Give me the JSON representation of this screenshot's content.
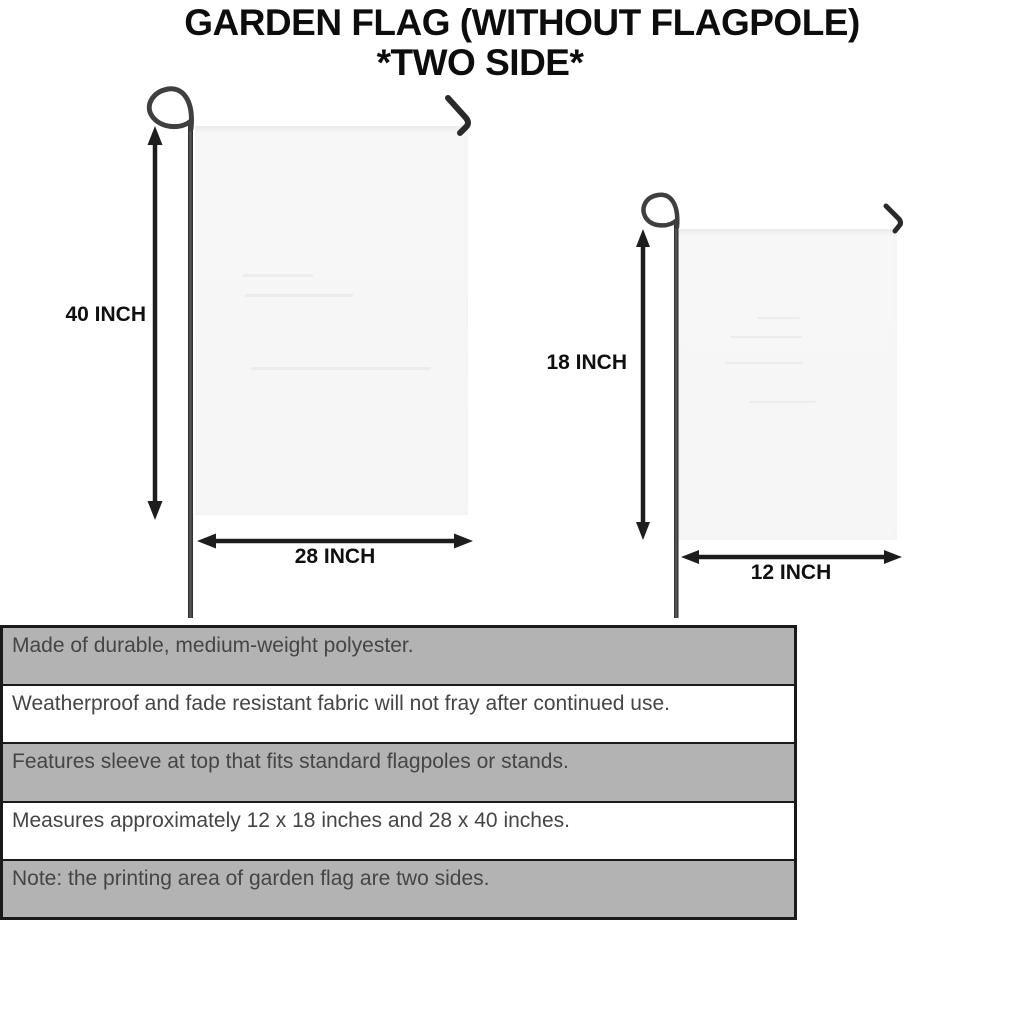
{
  "title": {
    "line1": "GARDEN FLAG (WITHOUT FLAGPOLE)",
    "line2": "*TWO SIDE*"
  },
  "diagram": {
    "large_flag": {
      "name": "large garden flag",
      "height_label": "40 INCH",
      "width_label": "28 INCH"
    },
    "small_flag": {
      "name": "small garden flag",
      "height_label": "18 INCH",
      "width_label": "12 INCH"
    }
  },
  "features": [
    "Made of durable, medium-weight polyester.",
    "Weatherproof and fade resistant fabric will not fray after continued use.",
    "Features sleeve at top that fits standard flagpoles or stands.",
    "Measures approximately 12 x 18 inches and 28 x 40 inches.",
    "Note: the printing area of garden flag are two sides."
  ],
  "colors": {
    "table_row_gray": "#b3b3b3",
    "table_row_white": "#ffffff",
    "table_border": "#1a1a1a",
    "flag_fill": "#f6f6f6",
    "pole": "#3f3f3f",
    "arrow": "#1d1d1d",
    "feature_text": "#454545",
    "title_text": "#0d0d0d"
  }
}
